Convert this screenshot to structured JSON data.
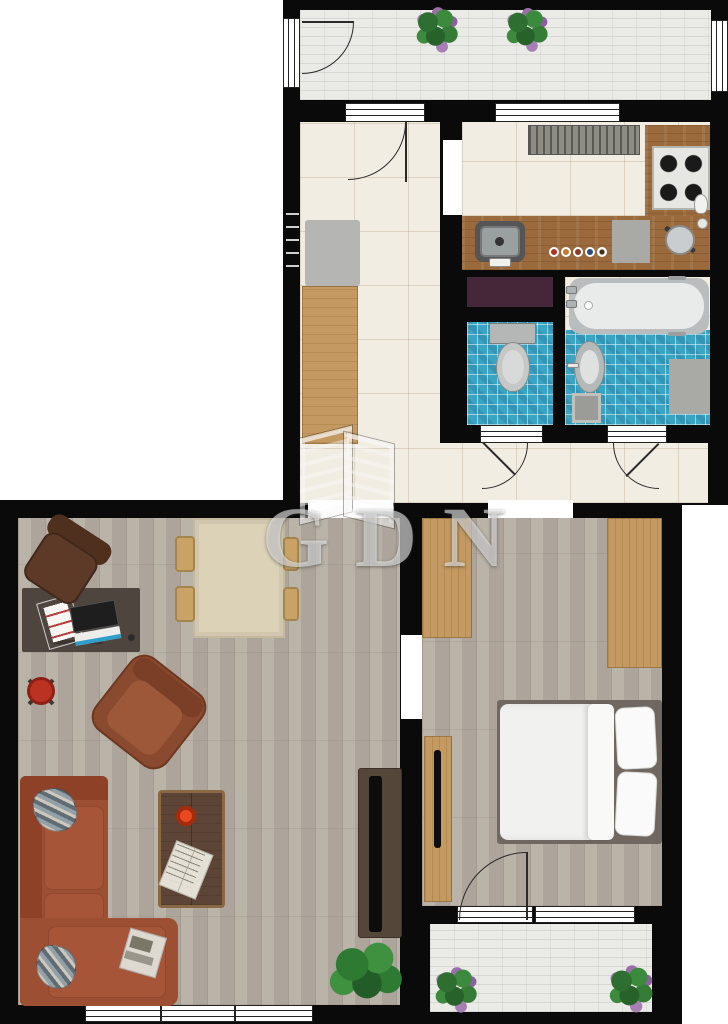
{
  "watermark": {
    "text": "GDN"
  },
  "colors": {
    "wall": "#0a0a0a",
    "floor_tile": "#f2ede3",
    "floor_plank": "#b6aea3",
    "balcony_brick": "#eaeae7",
    "counter_wood": "#9a6a3c",
    "furniture_oak": "#c49a62",
    "tile_blue": "#3ba4c2",
    "sofa_rust": "#9c4f33",
    "armchair_brown": "#8a4a2f",
    "chair_leather": "#5d3a28",
    "desk_brown": "#4e453e",
    "table_cream": "#dcd2b8",
    "coffee_walnut": "#53392a",
    "sideboard_brown": "#55463a",
    "bed_frame": "#6f6760",
    "bedding_white": "#f1f1f0",
    "tub_white": "#e9ebea",
    "fixture_gray": "#c0c2c1",
    "shelf_purple": "#46273a",
    "stool_red": "#bc3222",
    "tv_black": "#0d0d0d",
    "radiator_gray": "#8d8d85"
  }
}
